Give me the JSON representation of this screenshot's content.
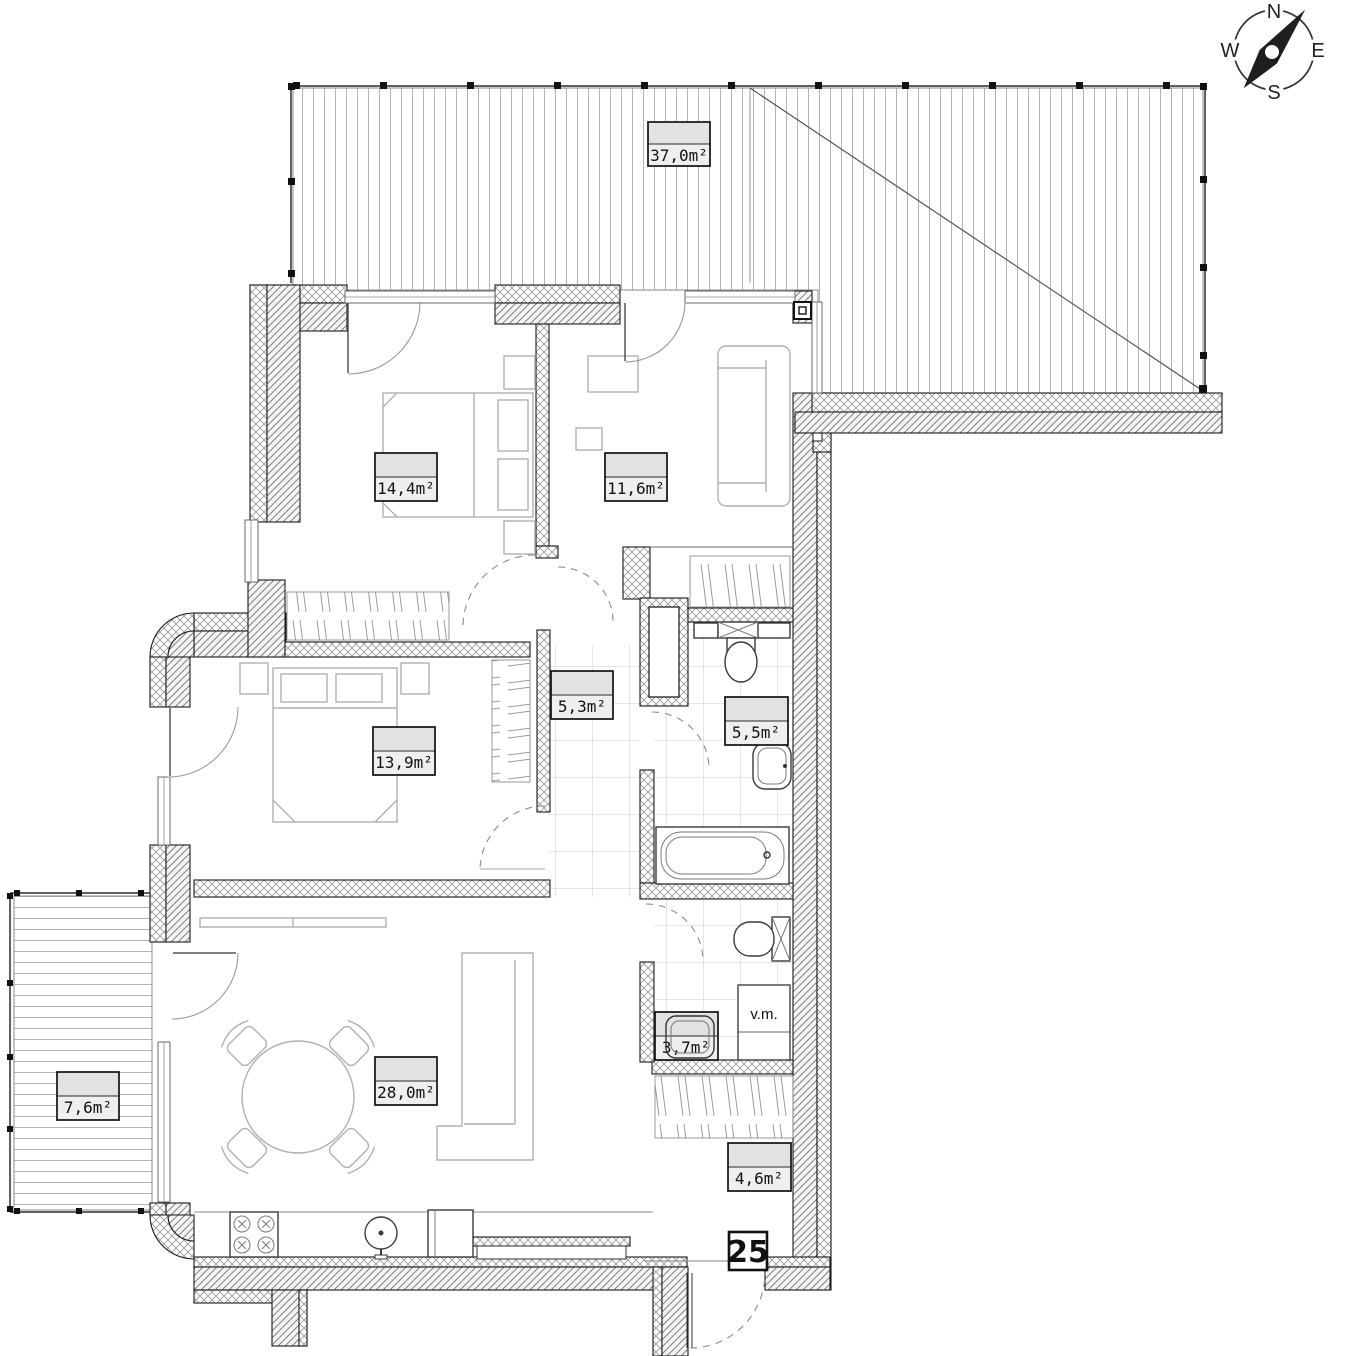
{
  "compass": {
    "north": "N",
    "east": "E",
    "south": "S",
    "west": "W"
  },
  "apartment": {
    "number": "25"
  },
  "annotations": {
    "washing_machine": "v.m."
  },
  "rooms": [
    {
      "name": "terrace",
      "area_label": "37,0m²"
    },
    {
      "name": "bedroom-1",
      "area_label": "14,4m²"
    },
    {
      "name": "bedroom-2",
      "area_label": "11,6m²"
    },
    {
      "name": "bedroom-3",
      "area_label": "13,9m²"
    },
    {
      "name": "hall",
      "area_label": "5,3m²"
    },
    {
      "name": "bathroom",
      "area_label": "5,5m²"
    },
    {
      "name": "wc",
      "area_label": "3,7m²"
    },
    {
      "name": "living-room-kitchen",
      "area_label": "28,0m²"
    },
    {
      "name": "entrance-hall",
      "area_label": "4,6m²"
    },
    {
      "name": "balcony",
      "area_label": "7,6m²"
    }
  ]
}
